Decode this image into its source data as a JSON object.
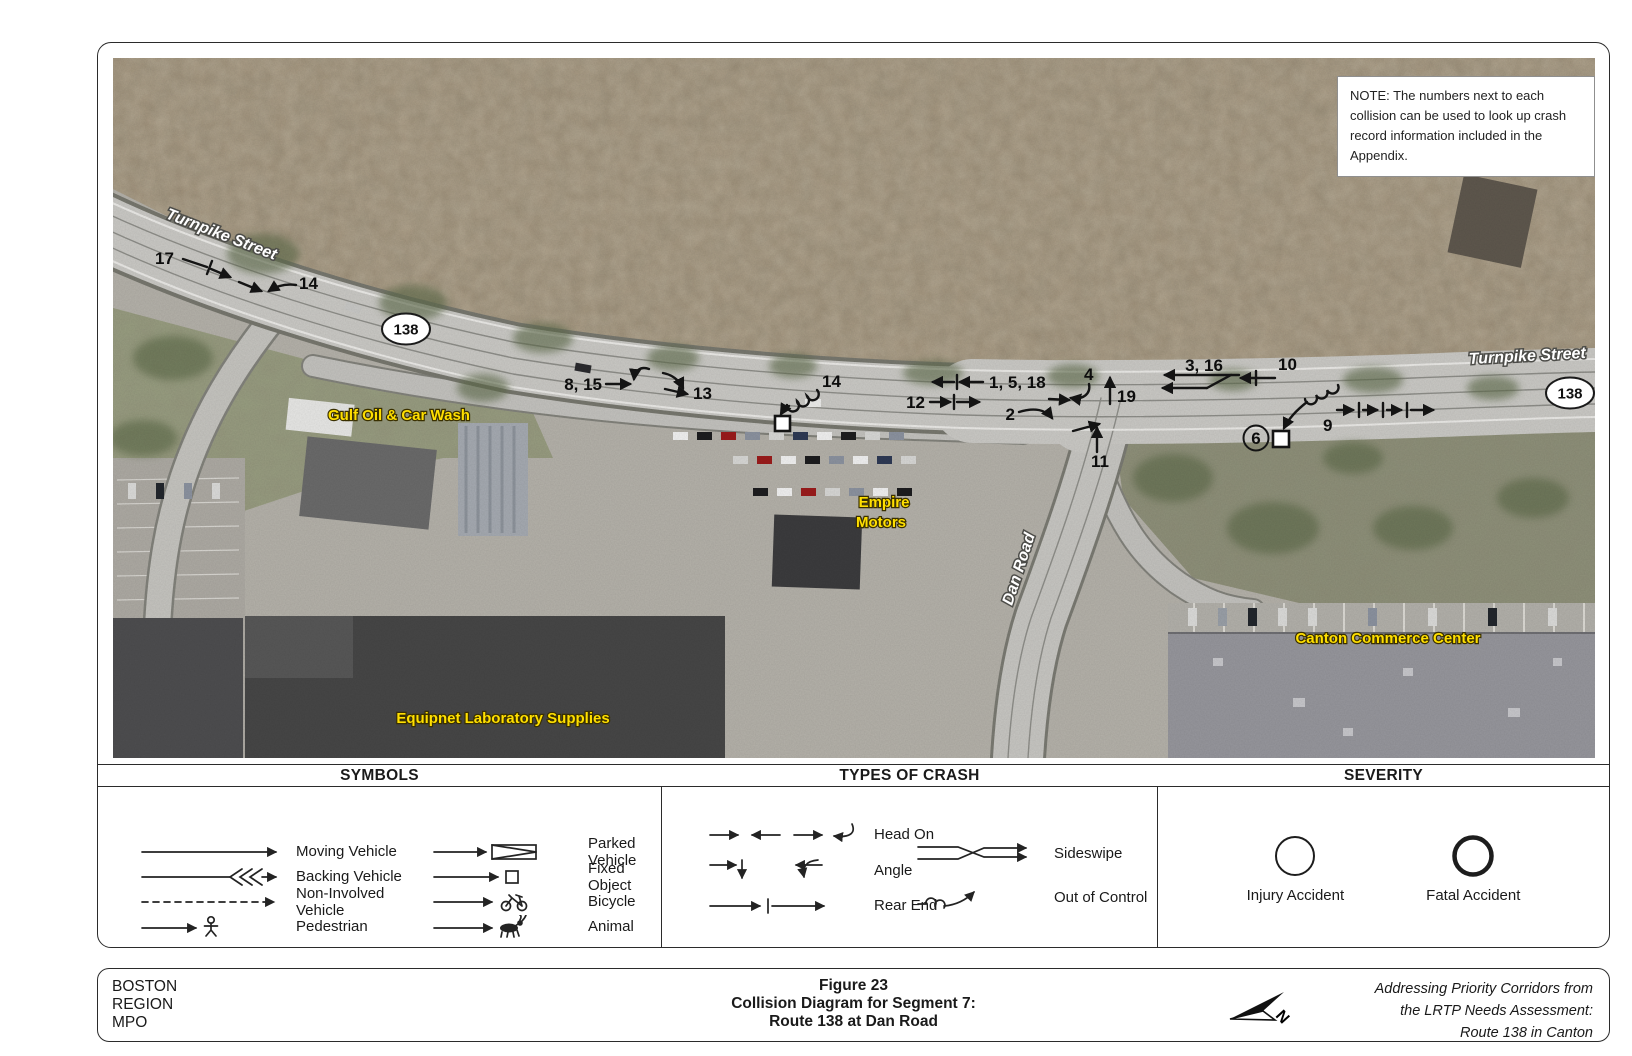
{
  "note": {
    "text": "NOTE: The numbers next to each collision can be used to look up crash record information included in the Appendix."
  },
  "map": {
    "streets": {
      "turnpike_left": "Turnpike Street",
      "turnpike_right": "Turnpike Street",
      "dan_road": "Dan Road"
    },
    "route_shields": {
      "left": "138",
      "right": "138"
    },
    "places": {
      "gulf": "Gulf Oil & Car Wash",
      "empire_line1": "Empire",
      "empire_line2": "Motors",
      "canton": "Canton Commerce Center",
      "equipnet": "Equipnet Laboratory Supplies"
    },
    "collision_labels": {
      "c17": "17",
      "c14_west": "14",
      "c8_15": "8, 15",
      "c13": "13",
      "c14_mid": "14",
      "c1_5_18": "1, 5, 18",
      "c12": "12",
      "c2": "2",
      "c4": "4",
      "c19": "19",
      "c11": "11",
      "c3_16": "3, 16",
      "c10": "10",
      "c6": "6",
      "c9": "9"
    }
  },
  "legend": {
    "symbols": {
      "title": "SYMBOLS",
      "items": [
        "Moving Vehicle",
        "Backing Vehicle",
        "Non-Involved Vehicle",
        "Pedestrian",
        "Parked Vehicle",
        "Fixed Object",
        "Bicycle",
        "Animal"
      ]
    },
    "types": {
      "title": "TYPES OF CRASH",
      "items": [
        "Head On",
        "Angle",
        "Rear End",
        "Sideswipe",
        "Out of Control"
      ]
    },
    "severity": {
      "title": "SEVERITY",
      "items": [
        "Injury Accident",
        "Fatal Accident"
      ]
    }
  },
  "footer": {
    "org_lines": [
      "BOSTON",
      "REGION",
      "MPO"
    ],
    "title_lines": [
      "Figure 23",
      "Collision Diagram for Segment 7:",
      "Route 138 at Dan Road"
    ],
    "credit_lines": [
      "Addressing Priority Corridors from",
      "the LRTP Needs Assessment:",
      "Route 138 in Canton"
    ],
    "north_label": "N"
  },
  "colors": {
    "place_label": "#ffdf00",
    "street_label": "#ffffff",
    "annotation": "#141414",
    "map_base": "#b5b2aa"
  }
}
